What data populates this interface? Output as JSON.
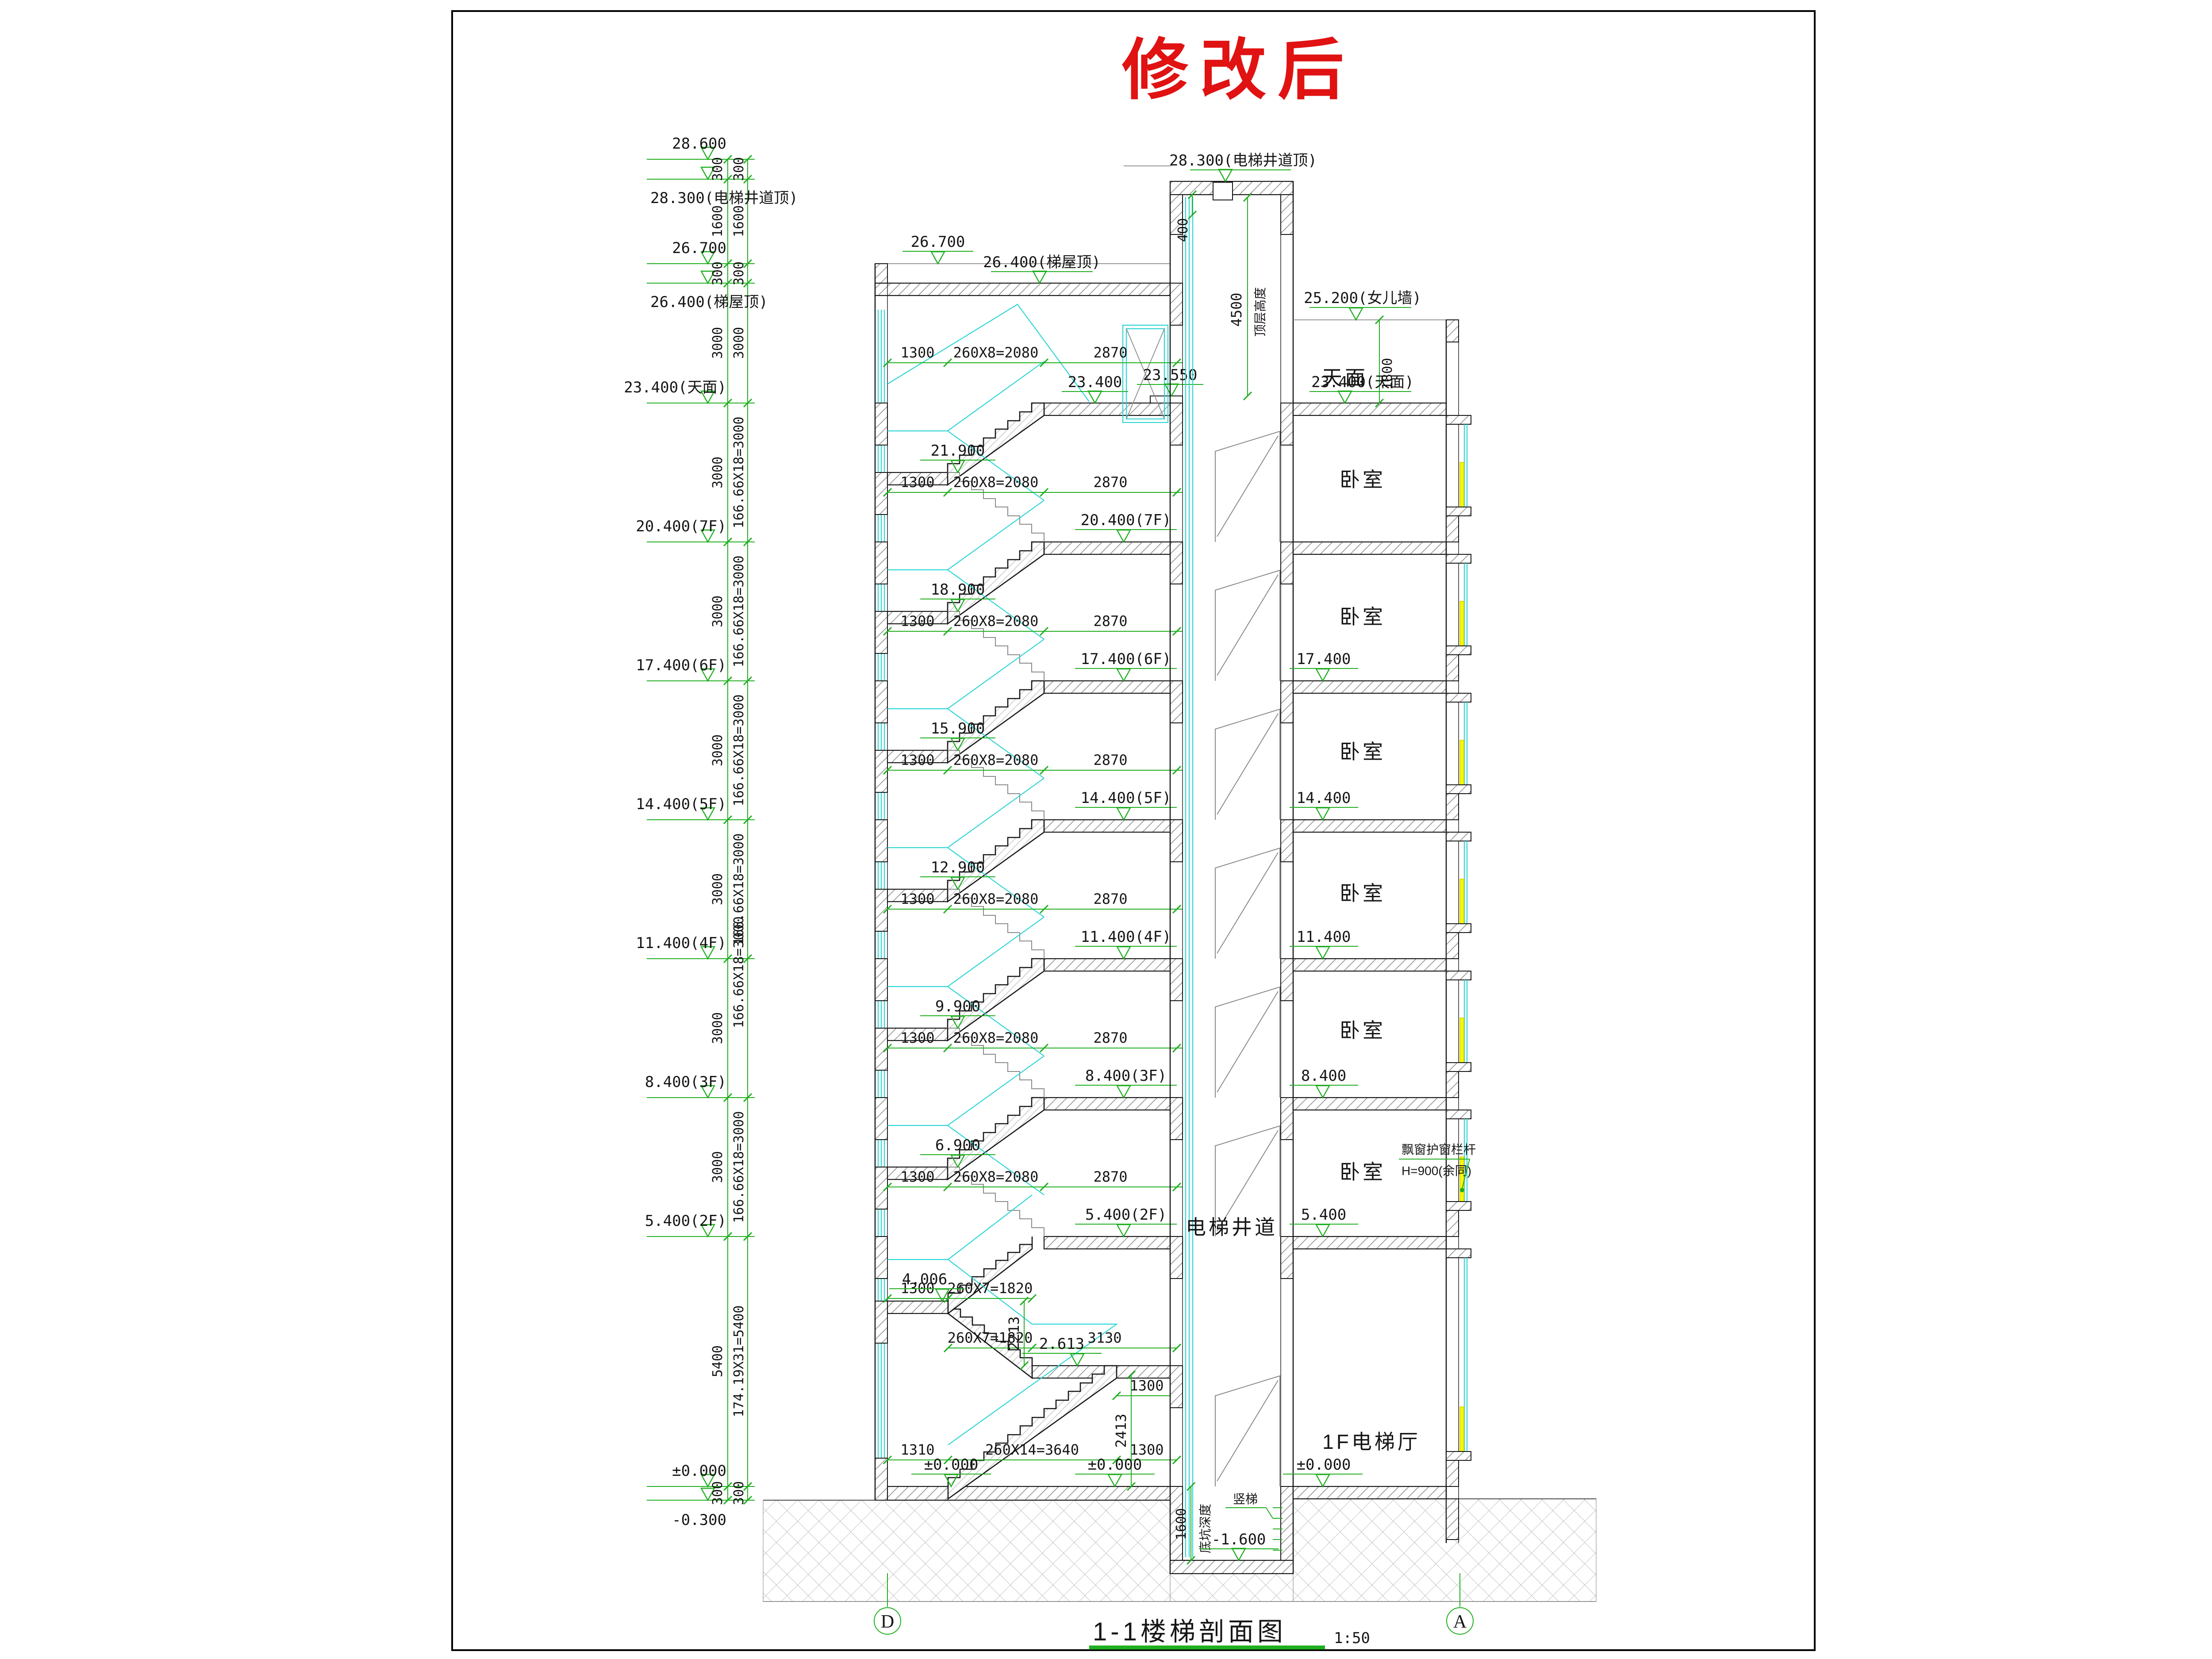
{
  "page": {
    "title": "修改后",
    "footer_title": "1-1楼梯剖面图",
    "footer_scale": "1:50",
    "axis_left": "D",
    "axis_right": "A"
  },
  "colors": {
    "annotation_green": "#1fae1f",
    "glazing_cyan": "#2fd4d4",
    "highlight_yellow": "#f7f70c",
    "title_red": "#e01212"
  },
  "left_column": {
    "levels": [
      "28.600",
      "28.300(电梯井道顶)",
      "26.700",
      "26.400(梯屋顶)",
      "23.400(天面)",
      "20.400(7F)",
      "17.400(6F)",
      "14.400(5F)",
      "11.400(4F)",
      "8.400(3F)",
      "5.400(2F)",
      "±0.000",
      "-0.300"
    ],
    "dims_col1": [
      "300",
      "1600",
      "300",
      "3000",
      "3000",
      "3000",
      "3000",
      "3000",
      "3000",
      "3000",
      "5400",
      "300"
    ],
    "dims_col2": [
      "300",
      "1600",
      "300",
      "3000",
      "166.66X18=3000",
      "166.66X18=3000",
      "166.66X18=3000",
      "166.66X18=3000",
      "166.66X18=3000",
      "166.66X18=3000",
      "174.19X31=5400",
      "300"
    ]
  },
  "stair": {
    "roof_level_label": "26.700",
    "roof_slab_label": "26.400(梯屋顶)",
    "roof_curb_label": "23.550",
    "roof_floor_label": "23.400",
    "dim_landing": "1300",
    "dim_run": "260X8=2080",
    "dim_well": "2870",
    "floors": [
      {
        "landing": "21.900",
        "floor": "20.400(7F)"
      },
      {
        "landing": "18.900",
        "floor": "17.400(6F)"
      },
      {
        "landing": "15.900",
        "floor": "14.400(5F)"
      },
      {
        "landing": "12.900",
        "floor": "11.400(4F)"
      },
      {
        "landing": "9.900",
        "floor": "8.400(3F)"
      },
      {
        "landing": "6.900",
        "floor": "5.400(2F)"
      }
    ],
    "mezz_label": "4.006",
    "mezz2_label": "2.613",
    "dim_run7": "260X7=1820",
    "dim_3130": "3130",
    "dim_1300b": "1300",
    "dim_1310": "1310",
    "dim_run14": "260X14=3640",
    "dim_1300c": "1300",
    "v2213": "2213",
    "v2413": "2413",
    "zero_a": "±0.000",
    "zero_b": "±0.000"
  },
  "shaft": {
    "name": "电梯井道",
    "top_label": "28.300(电梯井道顶)",
    "dim_400": "400",
    "dim_4500": "4500",
    "dim_4500_label": "顶层高度",
    "pit_dim": "1600",
    "pit_label": "底坑深度",
    "pit_level": "-1.600",
    "ladder_label": "竖梯"
  },
  "right": {
    "parapet_label": "25.200(女儿墙)",
    "roof_label": "23.400(天面)",
    "terrace_label": "天面",
    "terrace_dim": "1800",
    "levels": [
      "17.400",
      "14.400",
      "11.400",
      "8.400",
      "5.400"
    ],
    "zero": "±0.000",
    "room_label": "卧室",
    "hall_label": "1F电梯厅",
    "bay_note_1": "飘窗护窗栏杆",
    "bay_note_2": "H=900(余同)"
  }
}
